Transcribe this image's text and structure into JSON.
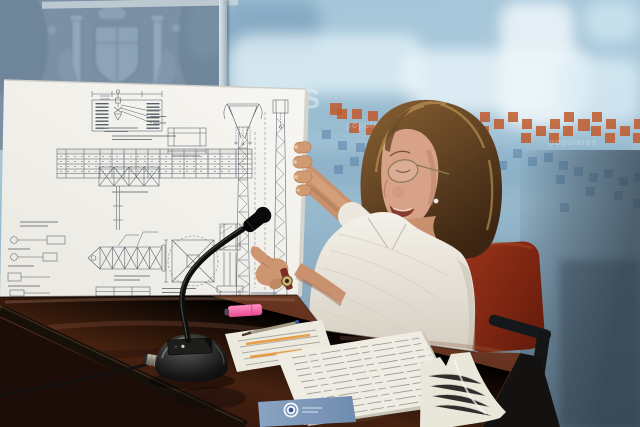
{
  "meta": {
    "alt": "Press conference photo: woman in a white striped blouse seated at a dark mahogany desk, holding and pointing at a white presentation board covered with technical drawings of a lattice pylon; black gooseneck microphone, documents, a pen and a pink highlighter lie on the desk; blue wall behind with a faded heraldic emblem, a pale cityscape mural, scattered orange and blue squares and faint watermark text."
  },
  "wall": {
    "big_letter": "S",
    "watermark_left": "populares",
    "watermark_right": "populares",
    "colors": {
      "panel_left": "#7b90a4",
      "mural": "#a9c9dc",
      "lower_right": "#51626f",
      "square_orange": "#bf5a2c",
      "square_blue": "#4f7da3"
    },
    "squares": [
      [
        330,
        103,
        2
      ],
      [
        337,
        109,
        0
      ],
      [
        352,
        109,
        0
      ],
      [
        349,
        123,
        0
      ],
      [
        368,
        111,
        0
      ],
      [
        366,
        125,
        0
      ],
      [
        382,
        117,
        0
      ],
      [
        396,
        111,
        0
      ],
      [
        395,
        125,
        0
      ],
      [
        410,
        107,
        0
      ],
      [
        409,
        121,
        0
      ],
      [
        424,
        113,
        0
      ],
      [
        438,
        107,
        0
      ],
      [
        437,
        121,
        2
      ],
      [
        452,
        113,
        0
      ],
      [
        451,
        127,
        0
      ],
      [
        466,
        119,
        0
      ],
      [
        480,
        112,
        0
      ],
      [
        479,
        126,
        0
      ],
      [
        494,
        119,
        0
      ],
      [
        508,
        112,
        0
      ],
      [
        522,
        119,
        0
      ],
      [
        521,
        133,
        0
      ],
      [
        536,
        126,
        0
      ],
      [
        550,
        119,
        0
      ],
      [
        549,
        133,
        0
      ],
      [
        564,
        112,
        0
      ],
      [
        563,
        126,
        0
      ],
      [
        578,
        119,
        2
      ],
      [
        592,
        112,
        0
      ],
      [
        591,
        126,
        0
      ],
      [
        606,
        119,
        0
      ],
      [
        605,
        133,
        0
      ],
      [
        620,
        126,
        0
      ],
      [
        634,
        119,
        0
      ],
      [
        633,
        133,
        0
      ],
      [
        322,
        130,
        1
      ],
      [
        334,
        165,
        1
      ],
      [
        338,
        141,
        1
      ],
      [
        350,
        157,
        1
      ],
      [
        356,
        143,
        1
      ],
      [
        373,
        139,
        1
      ],
      [
        380,
        153,
        1
      ],
      [
        389,
        133,
        1
      ],
      [
        404,
        145,
        1
      ],
      [
        412,
        159,
        1
      ],
      [
        420,
        147,
        1
      ],
      [
        436,
        143,
        1
      ],
      [
        444,
        163,
        1
      ],
      [
        452,
        151,
        1
      ],
      [
        467,
        157,
        1
      ],
      [
        478,
        170,
        1
      ],
      [
        482,
        153,
        1
      ],
      [
        498,
        161,
        1
      ],
      [
        513,
        149,
        1
      ],
      [
        528,
        157,
        1
      ],
      [
        544,
        153,
        1
      ],
      [
        556,
        175,
        1
      ],
      [
        559,
        161,
        1
      ],
      [
        560,
        203,
        1
      ],
      [
        574,
        167,
        1
      ],
      [
        586,
        187,
        1
      ],
      [
        589,
        173,
        1
      ],
      [
        604,
        169,
        1
      ],
      [
        614,
        191,
        1
      ],
      [
        619,
        177,
        1
      ],
      [
        633,
        199,
        1
      ],
      [
        634,
        173,
        1
      ]
    ]
  },
  "board": {
    "surface": "#f3f2ee",
    "ink": "#46525e"
  },
  "desk": {
    "surface_dark": "#23100b",
    "surface_light": "#7c462f",
    "trim": "#171009"
  },
  "chair": {
    "red": "#8f2b15"
  },
  "microphone": {
    "body": "#0d0d0b"
  },
  "highlighter": {
    "pink": "#ef5f9e"
  },
  "papers": {
    "highlight": "#e8932f",
    "card_blue": "#8aa3c2"
  },
  "presenter": {
    "skin": "#cd9570",
    "hair_dark": "#4a2f18",
    "hair_light": "#c8a05e",
    "blouse": "#ece8e0",
    "watch_strap": "#7c2c20"
  }
}
